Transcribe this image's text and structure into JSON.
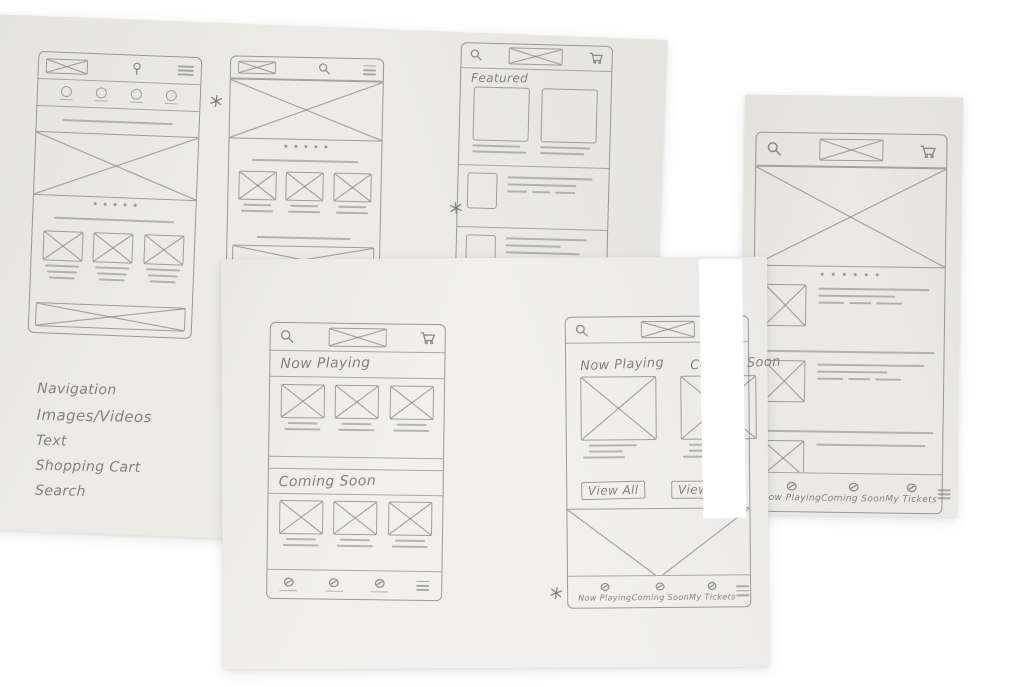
{
  "colors": {
    "background": "#ffffff",
    "paper": "#ecebe8",
    "pencil": "#8f8e8c",
    "handwriting": "#84827c"
  },
  "notes": {
    "items": [
      "Navigation",
      "Images/Videos",
      "Text",
      "Shopping Cart",
      "Search"
    ]
  },
  "icons": [
    "search-icon",
    "shopping-cart-icon",
    "hamburger-menu-icon",
    "location-pin-icon",
    "logo-placeholder",
    "image-placeholder",
    "star-doodle"
  ],
  "wf_featured": {
    "featured_label": "Featured"
  },
  "wf_list": {
    "nav_item1": "Now Playing",
    "nav_item2": "Coming Soon",
    "nav_item3": "My Tickets"
  },
  "wf_sections": {
    "section1_title": "Now Playing",
    "section2_title": "Coming Soon"
  },
  "wf_columns": {
    "col1_title": "Now Playing",
    "col2_title": "Coming Soon",
    "view_all1": "View All",
    "view_all2": "View All",
    "nav_item1": "Now Playing",
    "nav_item2": "Coming Soon",
    "nav_item3": "My Tickets"
  }
}
